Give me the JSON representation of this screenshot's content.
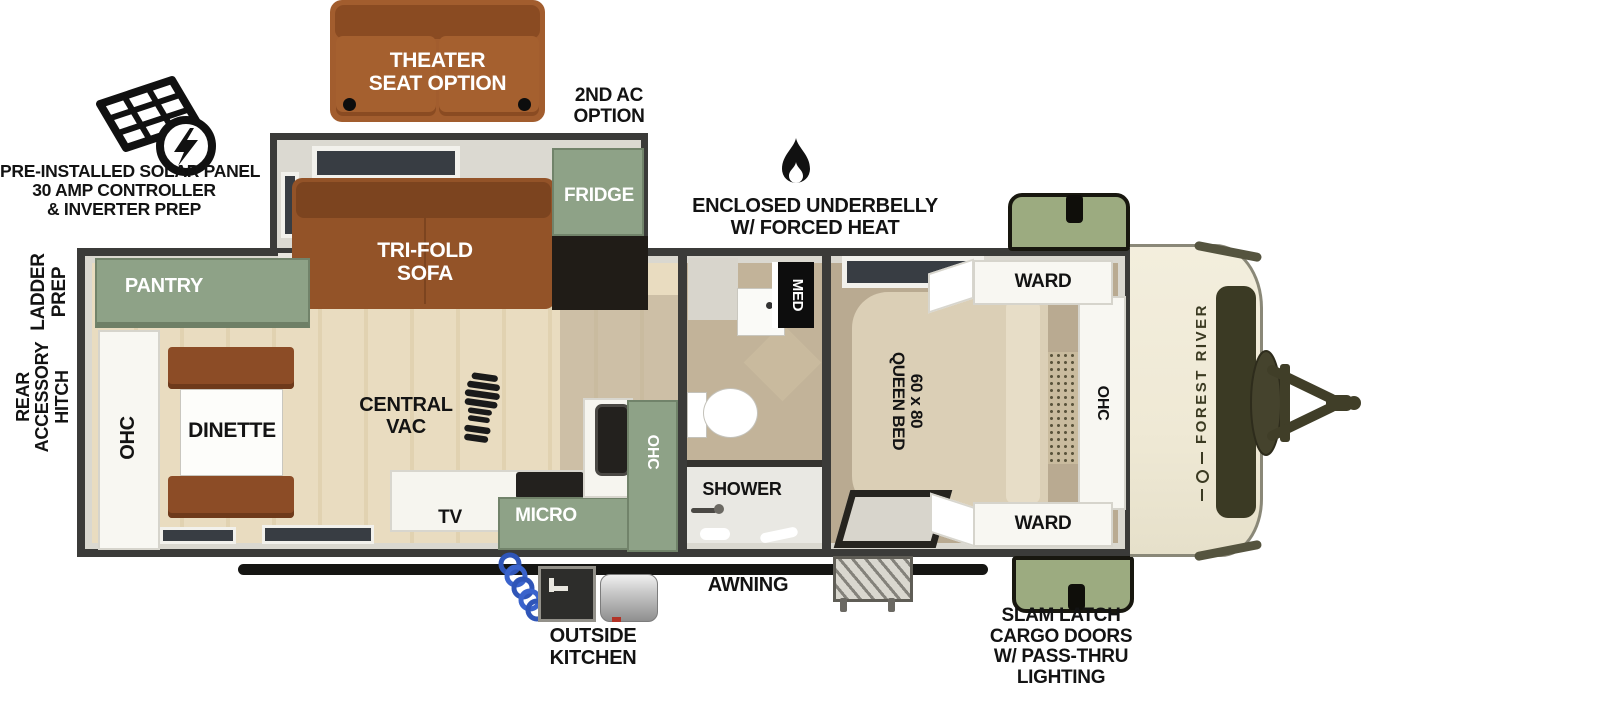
{
  "brand": {
    "name": "FOREST RIVER"
  },
  "callouts": {
    "solar": {
      "line1": "PRE-INSTALLED SOLAR PANEL",
      "line2": "30 AMP CONTROLLER",
      "line3": "& INVERTER PREP"
    },
    "theater_seat": {
      "line1": "THEATER",
      "line2": "SEAT OPTION"
    },
    "second_ac": {
      "line1": "2ND AC",
      "line2": "OPTION"
    },
    "underbelly": {
      "line1": "ENCLOSED UNDERBELLY",
      "line2": "W/ FORCED HEAT"
    },
    "ladder_prep": {
      "line1": "LADDER",
      "line2": "PREP"
    },
    "rear_accessory_hitch": {
      "line1": "REAR",
      "line2": "ACCESSORY",
      "line3": "HITCH"
    },
    "awning": "AWNING",
    "outside_kitchen": {
      "line1": "OUTSIDE",
      "line2": "KITCHEN"
    },
    "slam_latch": {
      "line1": "SLAM LATCH",
      "line2": "CARGO DOORS",
      "line3": "W/ PASS-THRU",
      "line4": "LIGHTING"
    }
  },
  "interior": {
    "pantry": "PANTRY",
    "ohc_rear": "OHC",
    "dinette": "DINETTE",
    "trifold_sofa": {
      "line1": "TRI-FOLD",
      "line2": "SOFA"
    },
    "fridge": "FRIDGE",
    "central_vac": {
      "line1": "CENTRAL",
      "line2": "VAC"
    },
    "tv": "TV",
    "micro": "MICRO",
    "ohc_kitchen": "OHC",
    "med": "MED",
    "shower": "SHOWER",
    "queen_bed": {
      "line1": "60 x 80",
      "line2": "QUEEN BED"
    },
    "ward_top": "WARD",
    "ward_bottom": "WARD",
    "ohc_bedroom": "OHC"
  },
  "colors": {
    "wall_dark": "#3b3b39",
    "cabinet_green": "#8ea287",
    "cargo_door_green": "#9cab80",
    "sofa_brown": "#935328",
    "theater_brown": "#a25d2e",
    "dinette_brown": "#8c4c26",
    "bed_tan": "#dbcfb6",
    "front_cap_cream": "#f1ebd9",
    "cap_accent_olive": "#3b3a24",
    "floor_wood": "#e9dcc0",
    "floor_bedroom": "#b9aa91",
    "hose_blue": "#2f55b8",
    "label_black": "#131313"
  }
}
